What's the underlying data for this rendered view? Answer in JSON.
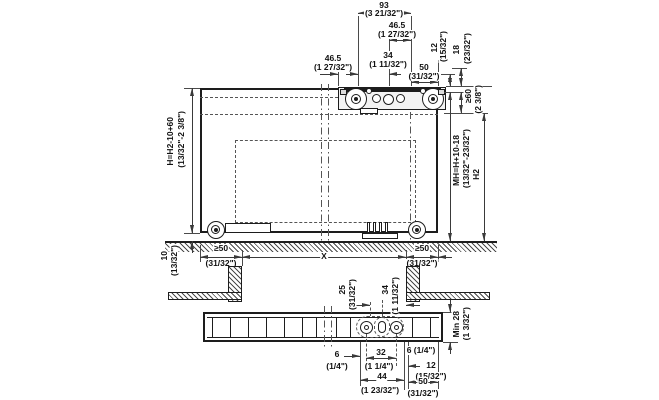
{
  "colors": {
    "line": "#1d1d1d",
    "dim": "#3a3a3a",
    "text": "#111111",
    "background": "#ffffff"
  },
  "main_view": {
    "dim_93": {
      "mm": "93",
      "inch": "(3 21/32\")"
    },
    "dim_46_5_top": {
      "mm": "46.5",
      "inch": "(1 27/32\")"
    },
    "dim_34": {
      "mm": "34",
      "inch": "(1 11/32\")"
    },
    "dim_50": {
      "mm": "50",
      "inch": "(31/32\")"
    },
    "dim_46_5_left": {
      "mm": "46.5",
      "inch": "(1 27/32\")"
    },
    "dim_12": {
      "mm": "12",
      "inch": "(15/32\")"
    },
    "dim_18": {
      "mm": "18",
      "inch": "(23/32\")"
    },
    "dim_min60": {
      "mm": "≥60",
      "inch": "(2 3/8\")"
    },
    "dim_mh": {
      "formula": "MH=H+10-18",
      "inch": "(13/32\"-23/32\")"
    },
    "dim_h2": {
      "label": "H2"
    },
    "dim_h": {
      "formula": "H=H2-10+60",
      "inch": "(13/32\"-2 3/8\")"
    },
    "dim_10": {
      "mm": "10",
      "inch": "(13/32\")"
    },
    "dim_min50_left": {
      "mm": "≥50",
      "inch": "(31/32\")"
    },
    "dim_x": {
      "label": "X"
    },
    "dim_min50_right": {
      "mm": "≥50",
      "inch": "(31/32\")"
    }
  },
  "bottom_view": {
    "dim_25": {
      "mm": "25",
      "inch": "(31/32\")"
    },
    "dim_34": {
      "mm": "34",
      "inch": "(1 11/32\")"
    },
    "dim_min28": {
      "mm": "Min 28",
      "inch": "(1 3/32\")"
    },
    "dim_6_left": {
      "mm": "6",
      "inch": "(1/4\")"
    },
    "dim_32": {
      "mm": "32",
      "inch": "(1 1/4\")"
    },
    "dim_6_right": {
      "label": "6 (1/4\")"
    },
    "dim_12": {
      "mm": "12",
      "inch": "(15/32\")"
    },
    "dim_44": {
      "mm": "44",
      "inch": "(1 23/32\")"
    },
    "dim_50": {
      "mm": "50",
      "inch": "(31/32\")"
    }
  }
}
